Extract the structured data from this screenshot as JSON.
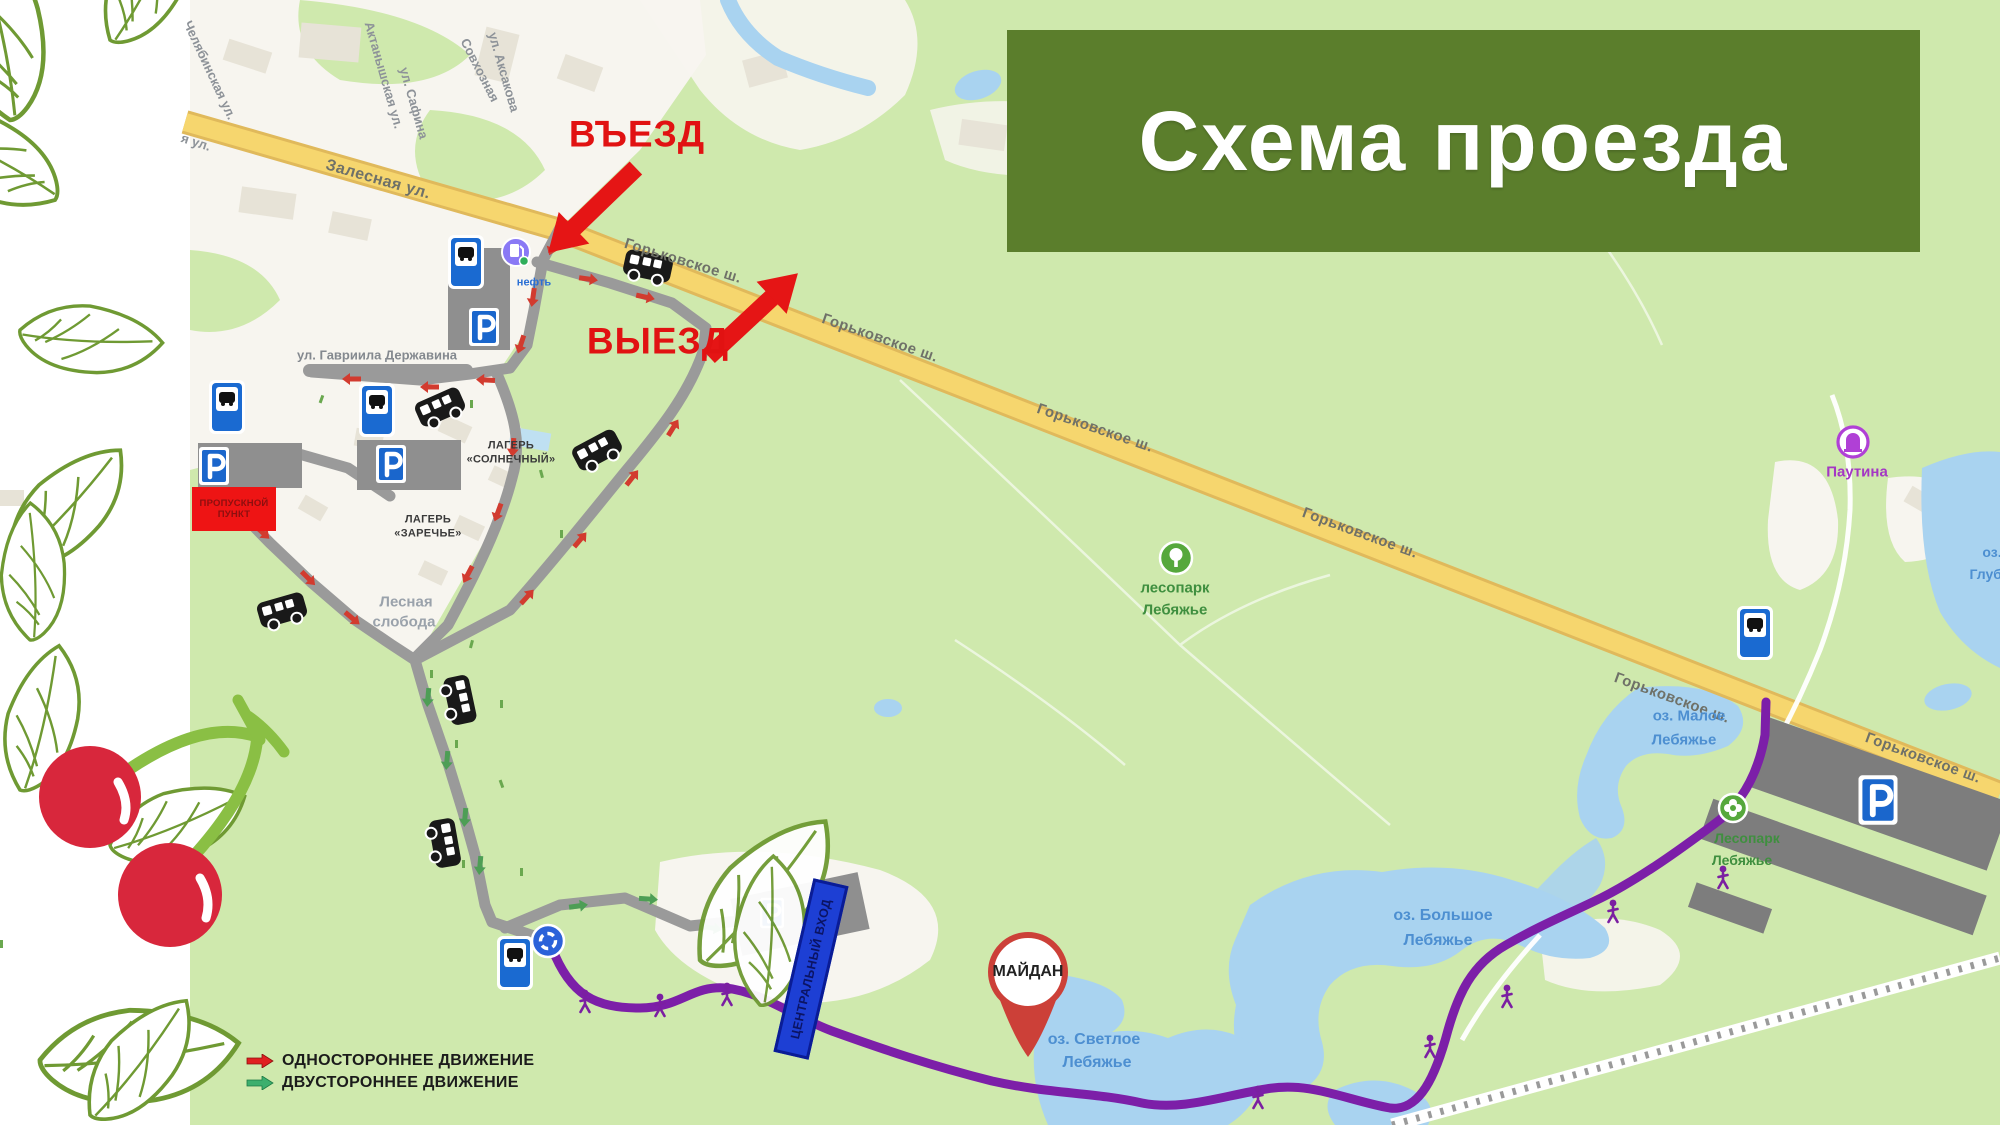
{
  "title_banner": {
    "text": "Схема проезда",
    "bg_color": "#5b7e2c",
    "text_color": "#ffffff"
  },
  "markers": {
    "entrance": "ВЪЕЗД",
    "exit": "ВЫЕЗД",
    "maidan": "МАЙДАН",
    "checkpoint_line1": "ПРОПУСКНОЙ",
    "checkpoint_line2": "ПУНКТ",
    "central_entrance": "ЦЕНТРАЛЬНЫЙ ВХОД"
  },
  "legend": {
    "one_way": "ОДНОСТОРОННЕЕ ДВИЖЕНИЕ",
    "two_way": "ДВУСТОРОННЕЕ ДВИЖЕНИЕ",
    "one_way_color": "#e02020",
    "two_way_color": "#3daf6e"
  },
  "roads": {
    "zalesnaya": "Залесная ул.",
    "gorkovskoe": "Горьковское ш.",
    "derzhavina": "ул. Гавриила Державина"
  },
  "side_streets": {
    "chelyabinskaya": "Челябинская ул.",
    "ya_ul": "я ул.",
    "aktanyshskaya": "Актанышская ул.",
    "safina": "ул. Сафина",
    "sovkhoznaya": "Совхозная",
    "aksakova": "ул. Аксакова"
  },
  "places": {
    "camp_sunny_1": "ЛАГЕРЬ",
    "camp_sunny_2": "«СОЛНЕЧНЫЙ»",
    "camp_zarechye_1": "ЛАГЕРЬ",
    "camp_zarechye_2": "«ЗАРЕЧЬЕ»",
    "lesnaya_sloboda_1": "Лесная",
    "lesnaya_sloboda_2": "слобода",
    "lesopark_1": "лесопарк",
    "lesopark_2": "Лебяжье",
    "lesopark_right_1": "Лесопарк",
    "lesopark_right_2": "Лебяжье",
    "pautina": "Паутина",
    "gas_label": "нефть"
  },
  "lakes": {
    "maloe_1": "оз. Малое",
    "maloe_2": "Лебяжье",
    "bolshoe_1": "оз. Большое",
    "bolshoe_2": "Лебяжье",
    "svetloe_1": "оз. Светлое",
    "svetloe_2": "Лебяжье",
    "glubokoe_1": "оз.",
    "glubokoe_2": "Глубо"
  },
  "icons": {
    "bus_stop_sign": "blue square sign with bus glyph",
    "parking_sign": "blue square with white P",
    "bus": "black shuttle bus, side view",
    "walker": "purple walking person",
    "roundabout": "blue circle with white ring arrows",
    "gas_station": "violet circle fuel pump",
    "tree_poi": "green circle with white tree",
    "flower_poi": "green circle with white flower",
    "pautina_poi": "white circle with purple attraction glyph",
    "maidan_pin": "red map pin with white circle"
  },
  "colors": {
    "map_green": "#cfe9ad",
    "urban_white": "#f7f5ef",
    "highway_yellow": "#f6d66e",
    "road_gray": "#9a9a9a",
    "water_blue": "#a9d3f0",
    "route_purple": "#7c1fa8",
    "pin_red": "#cc4038"
  }
}
